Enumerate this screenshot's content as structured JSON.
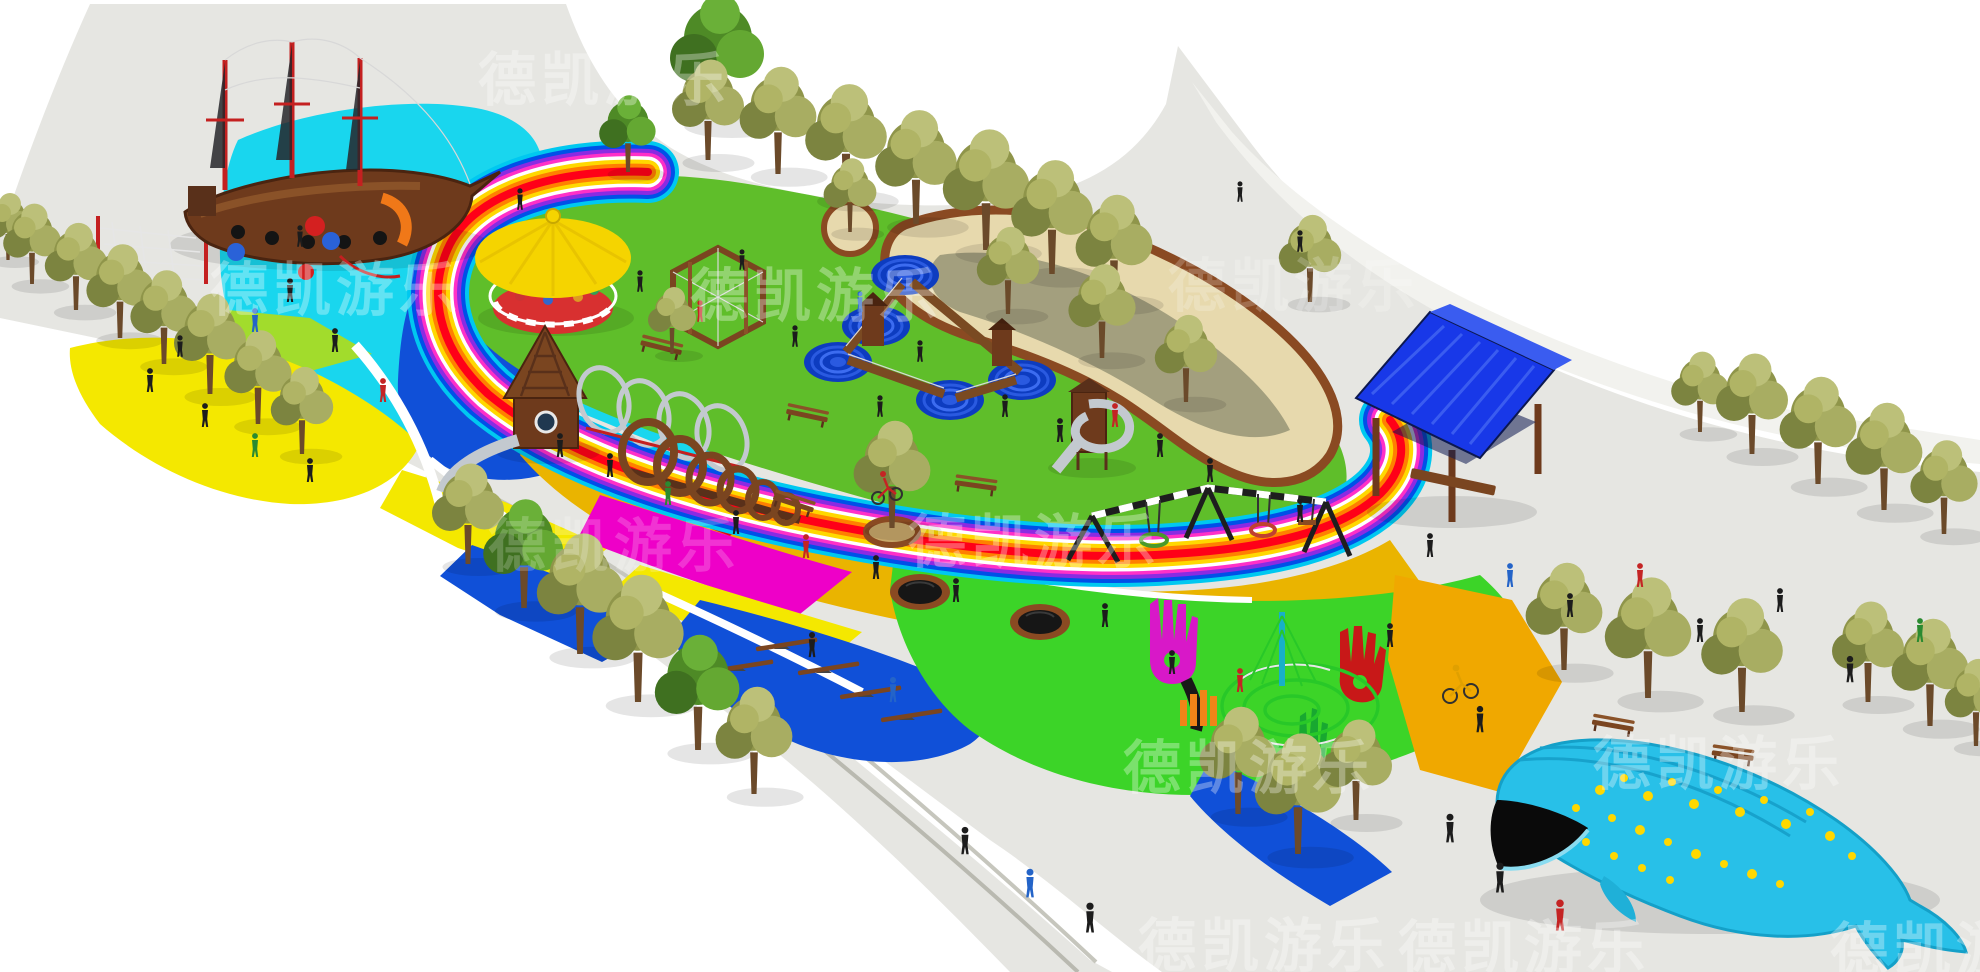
{
  "watermark_text": "德凯游乐",
  "watermarks": [
    {
      "text": "德凯游乐"
    },
    {
      "text": "德凯游乐"
    },
    {
      "text": "德凯游乐"
    },
    {
      "text": "德凯游乐"
    },
    {
      "text": "德凯游乐"
    },
    {
      "text": "德凯游乐"
    },
    {
      "text": "德凯游乐"
    },
    {
      "text": "德凯游乐"
    },
    {
      "text": "德凯游乐"
    },
    {
      "text": "德凯游乐"
    },
    {
      "text": "德凯游乐"
    }
  ],
  "colors": {
    "white": "#ffffff",
    "plaza": "#e6e6e2",
    "plaza_light": "#f2f2ee",
    "curb": "#d8d8d1",
    "lawn": "#5fbe2a",
    "cyan": "#19d6ee",
    "blue": "#1050d8",
    "blue_deep": "#0d3cc0",
    "yellow": "#f4e800",
    "lime": "#a2dc2c",
    "amber": "#eab400",
    "gold": "#f0a800",
    "red": "#e60018",
    "magenta": "#ee00c8",
    "green_bright": "#3cd428",
    "sand": "#e7d9ad",
    "sand_edge": "#8a4a22",
    "wood": "#7a4520",
    "wood_dark": "#59301a",
    "ship": "#6e3a1c",
    "mast_red": "#c42020",
    "carousel": "#f5d400",
    "carousel_base": "#d83030",
    "pavilion": "#1838e8",
    "pavilion_dark": "#0c1850",
    "whale": "#28c0e8",
    "whale_dark": "#17a2cc",
    "spot": "#ffd800",
    "steel": "#c3c9cf",
    "maze_net": "#28c828",
    "tree_olive": "#9aa052",
    "tree_green": "#4e8a26",
    "people": "#1c1c1c",
    "rainbow": [
      "#00c8f0",
      "#0050e8",
      "#8a2be2",
      "#ff30c8",
      "#ffffff",
      "#ffd800",
      "#ff8000",
      "#ff0018"
    ]
  }
}
